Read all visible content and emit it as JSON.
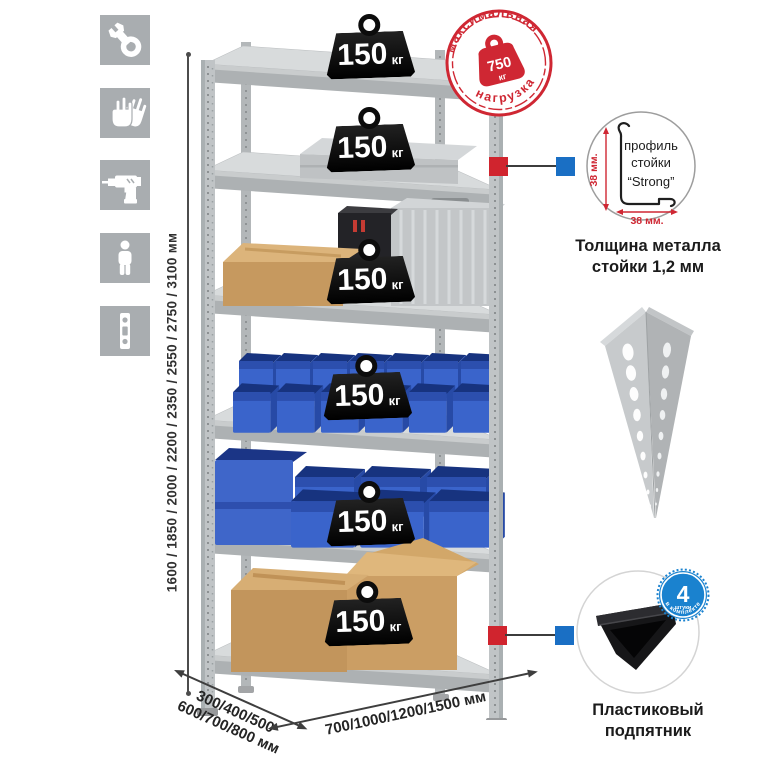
{
  "colors": {
    "accent_red": "#d0242e",
    "accent_blue": "#1a82cf",
    "bin_blue": "#3a64cb",
    "metal_gray": "#c3c6c8",
    "icon_gray": "#a9adb0",
    "cardboard": "#c89a5f"
  },
  "left_icons": {
    "items": [
      {
        "name": "wrench"
      },
      {
        "name": "gloves"
      },
      {
        "name": "drill"
      },
      {
        "name": "person"
      },
      {
        "name": "level"
      }
    ]
  },
  "height_dimension": {
    "label": "1600 / 1850 / 2000 / 2200 / 2350 / 2550 / 2750 / 3100 мм"
  },
  "rack": {
    "shelf_loads": [
      {
        "value": "150",
        "unit": "кг"
      },
      {
        "value": "150",
        "unit": "кг"
      },
      {
        "value": "150",
        "unit": "кг"
      },
      {
        "value": "150",
        "unit": "кг"
      },
      {
        "value": "150",
        "unit": "кг"
      },
      {
        "value": "150",
        "unit": "кг"
      }
    ]
  },
  "max_load_stamp": {
    "arc_top": "максимальная",
    "arc_bottom": "нагрузка",
    "value": "750",
    "unit": "кг"
  },
  "profile_detail": {
    "label_line1": "профиль",
    "label_line2": "стойки",
    "label_line3": "“Strong”",
    "vertical_dim": "38 мм.",
    "horizontal_dim": "38 мм.",
    "caption_line1": "Толщина металла",
    "caption_line2": "стойки 1,2 мм"
  },
  "foot_detail": {
    "badge_value": "4",
    "badge_unit": "штуки",
    "badge_arc": "в комплекте",
    "caption_line1": "Пластиковый",
    "caption_line2": "подпятник"
  },
  "depth_dimension": {
    "line1": "300/400/500",
    "line2": "600/700/800 мм"
  },
  "width_dimension": {
    "label": "700/1000/1200/1500 мм"
  }
}
